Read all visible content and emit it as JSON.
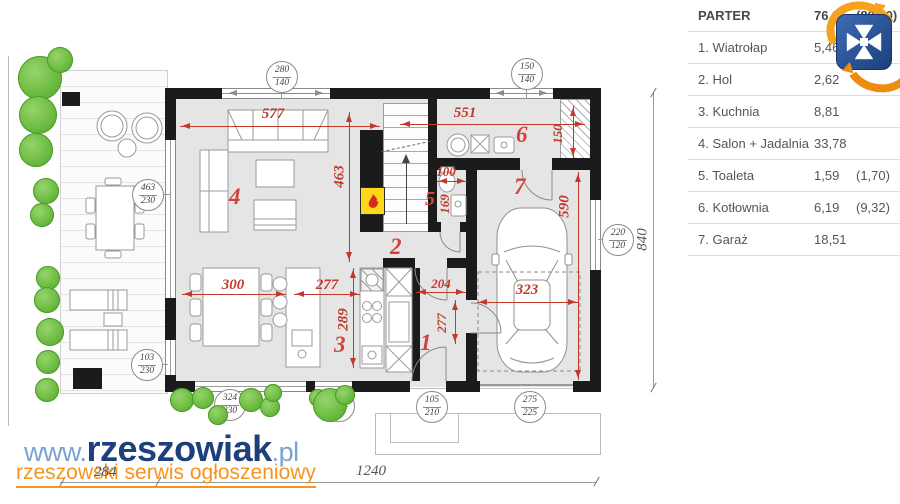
{
  "legend": {
    "header": {
      "label": "PARTER",
      "area": "76,96",
      "area_alt": "(80,20)"
    },
    "rows": [
      {
        "label": "1. Wiatrołap",
        "area": "5,46",
        "area_alt": ""
      },
      {
        "label": "2. Hol",
        "area": "2,62",
        "area_alt": ""
      },
      {
        "label": "3. Kuchnia",
        "area": "8,81",
        "area_alt": ""
      },
      {
        "label": "4. Salon + Jadalnia",
        "area": "33,78",
        "area_alt": ""
      },
      {
        "label": "5. Toaleta",
        "area": "1,59",
        "area_alt": "(1,70)"
      },
      {
        "label": "6. Kotłownia",
        "area": "6,19",
        "area_alt": "(9,32)"
      },
      {
        "label": "7. Garaż",
        "area": "18,51",
        "area_alt": ""
      }
    ]
  },
  "watermark": {
    "www": "www.",
    "brand": "rzeszowiak",
    "tld": ".pl",
    "tagline": "rzeszowski serwis ogłoszeniowy"
  },
  "plan": {
    "room_numbers": [
      "1",
      "2",
      "3",
      "4",
      "5",
      "6",
      "7"
    ],
    "red_dims": {
      "salon_width": "577",
      "top_right_width": "551",
      "salon_depth": "463",
      "chimney_width": "150",
      "toilet_width": "100",
      "toilet_depth": "169",
      "garage_depth": "590",
      "garage_width": "323",
      "dining_width": "300",
      "kitchen_width": "277",
      "kitchen_depth": "289",
      "hall_width": "204",
      "hall_depth": "277"
    },
    "gray_dims": {
      "plot_width": "1240",
      "terrace_width": "284",
      "plot_depth": "840"
    },
    "windows": [
      {
        "w": "280",
        "h": "140"
      },
      {
        "w": "150",
        "h": "140"
      },
      {
        "w": "463",
        "h": "230"
      },
      {
        "w": "220",
        "h": "120"
      },
      {
        "w": "103",
        "h": "230"
      },
      {
        "w": "324",
        "h": "230"
      },
      {
        "w": "110",
        "h": "230"
      },
      {
        "w": "105",
        "h": "210"
      },
      {
        "w": "275",
        "h": "225"
      }
    ]
  },
  "colors": {
    "wall": "#1b1b1b",
    "dim_red": "#c0392b",
    "bush_green": "#69b93e",
    "brand_blue": "#1d3f7b",
    "brand_light_blue": "#7ba3cd",
    "accent_orange": "#f7941d",
    "logo_blue": "#2b5ca8"
  }
}
